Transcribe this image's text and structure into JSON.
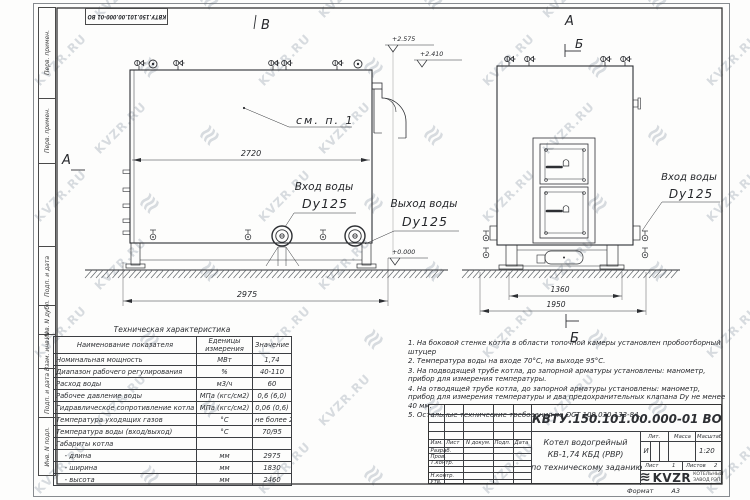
{
  "watermark": {
    "text": "KVZR.RU",
    "logo_glyph": "≋"
  },
  "stamp_top": "КВТУ.150.101.00.000-01 ВО",
  "frame": {
    "left_fields": [
      "Перв. примен.",
      "Перв. примен.",
      "",
      "Подп. и дата",
      "Инв. N дубл.",
      "Взам. инв. N",
      "Подп. и дата",
      "Инв. N подл."
    ],
    "format_label": "Формат",
    "format_value": "А3"
  },
  "drawing": {
    "view_b": "В",
    "view_a_front": "А",
    "view_a_side": "А",
    "section_b_top": "Б",
    "section_b_bottom": "Б",
    "callout_see": "см. п. 1",
    "dim_2720": "2720",
    "dim_2975": "2975",
    "dim_1360": "1360",
    "dim_1950": "1950",
    "elev_1": "+2.575",
    "elev_2": "+2.410",
    "elev_0": "+0.000",
    "inlet_front_l1": "Вход воды",
    "inlet_front_l2": "Dy125",
    "outlet_front_l1": "Выход воды",
    "outlet_front_l2": "Dy125",
    "inlet_side_l1": "Вход воды",
    "inlet_side_l2": "Dy125"
  },
  "tech_table": {
    "title": "Техническая характеристика",
    "headers": [
      "Наименование показателя",
      "Еденицы измерения",
      "Значение"
    ],
    "rows": [
      [
        "Номинальная мощность",
        "МВт",
        "1,74"
      ],
      [
        "Диапазон рабочего регулирования",
        "%",
        "40-110"
      ],
      [
        "Расход воды",
        "м3/ч",
        "60"
      ],
      [
        "Рабочее давление воды",
        "МПа (кгс/см2)",
        "0,6 (6,0)"
      ],
      [
        "Гидравлическое сопротивление котла",
        "МПа (кгс/см2)",
        "0,06 (0,6)"
      ],
      [
        "Температура уходящих газов",
        "°С",
        "не более 280"
      ],
      [
        "Температура воды (вход/выход)",
        "°С",
        "70/95"
      ],
      [
        "Габариты котла",
        "",
        ""
      ],
      [
        "    - длина",
        "мм",
        "2975"
      ],
      [
        "    - ширина",
        "мм",
        "1830"
      ],
      [
        "    - высота",
        "мм",
        "2460"
      ]
    ]
  },
  "notes": [
    "1.  На боковой стенке котла в области топочной камеры установлен пробоотборный штуцер",
    "2.  Температура воды на входе 70°С, на выходе 95°С.",
    "3.  На подводящей трубе котла, до запорной арматуры установлены: манометр, прибор для измерения температуры.",
    "4.  На отводящей трубе котла, до запорной арматуры установлены: манометр, прибор для измерения температуры и два предохранительных клапана Dу не менее 40 мм.",
    "5.  Остальные технические требования по ОСТ 108.030.133-84."
  ],
  "title_block": {
    "doc_number": "КВТУ.150.101.00.000-01 ВО",
    "title_lines": [
      "Котел водогрейный",
      "КВ-1,74 КБД (РВР)",
      "по техническому заданию"
    ],
    "header_cols": [
      "Изм.",
      "Лист",
      "N докум.",
      "Подп.",
      "Дата"
    ],
    "rows": [
      "Разраб.",
      "Пров.",
      "Т.контр.",
      "",
      "Н.контр.",
      "Утв."
    ],
    "lit_label": "Лит.",
    "lit_value": "И",
    "mass_label": "Масса",
    "mass_value": "",
    "scale_label": "Масштаб",
    "scale_value": "1:20",
    "sheet_label": "Лист",
    "sheet_value": "1",
    "sheets_label": "Листов",
    "sheets_value": "2",
    "company_logo": "KVZR",
    "company_sub1": "КОТЕЛЬНЫЙ",
    "company_sub2": "ЗАВОД РЭП"
  }
}
